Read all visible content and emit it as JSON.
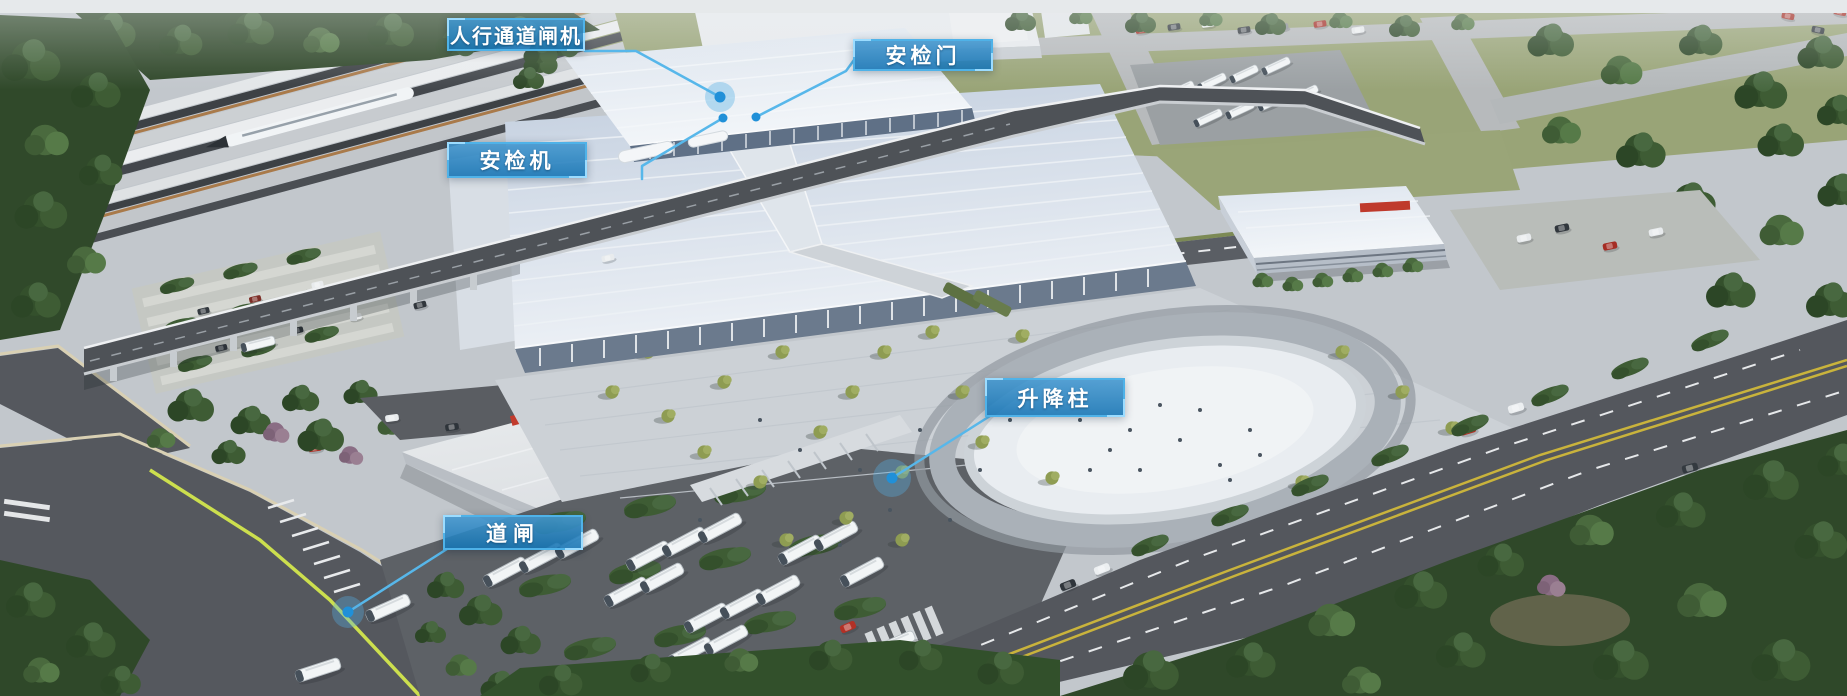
{
  "callouts": [
    {
      "id": "pedestrian-channel-gate",
      "label": "人行通道闸机"
    },
    {
      "id": "security-door",
      "label": "安检门"
    },
    {
      "id": "security-scanner",
      "label": "安检机"
    },
    {
      "id": "lift-bollard",
      "label": "升降柱"
    },
    {
      "id": "barrier-gate",
      "label": "道闸"
    }
  ],
  "palette": {
    "callout_fill": "#1980c4",
    "callout_border": "#4fb2e8",
    "callout_corner_accent": "#9bdcff",
    "leader_line": "#57b7ea",
    "marker_dot": "#2090d8",
    "callout_text": "#ffffff"
  }
}
